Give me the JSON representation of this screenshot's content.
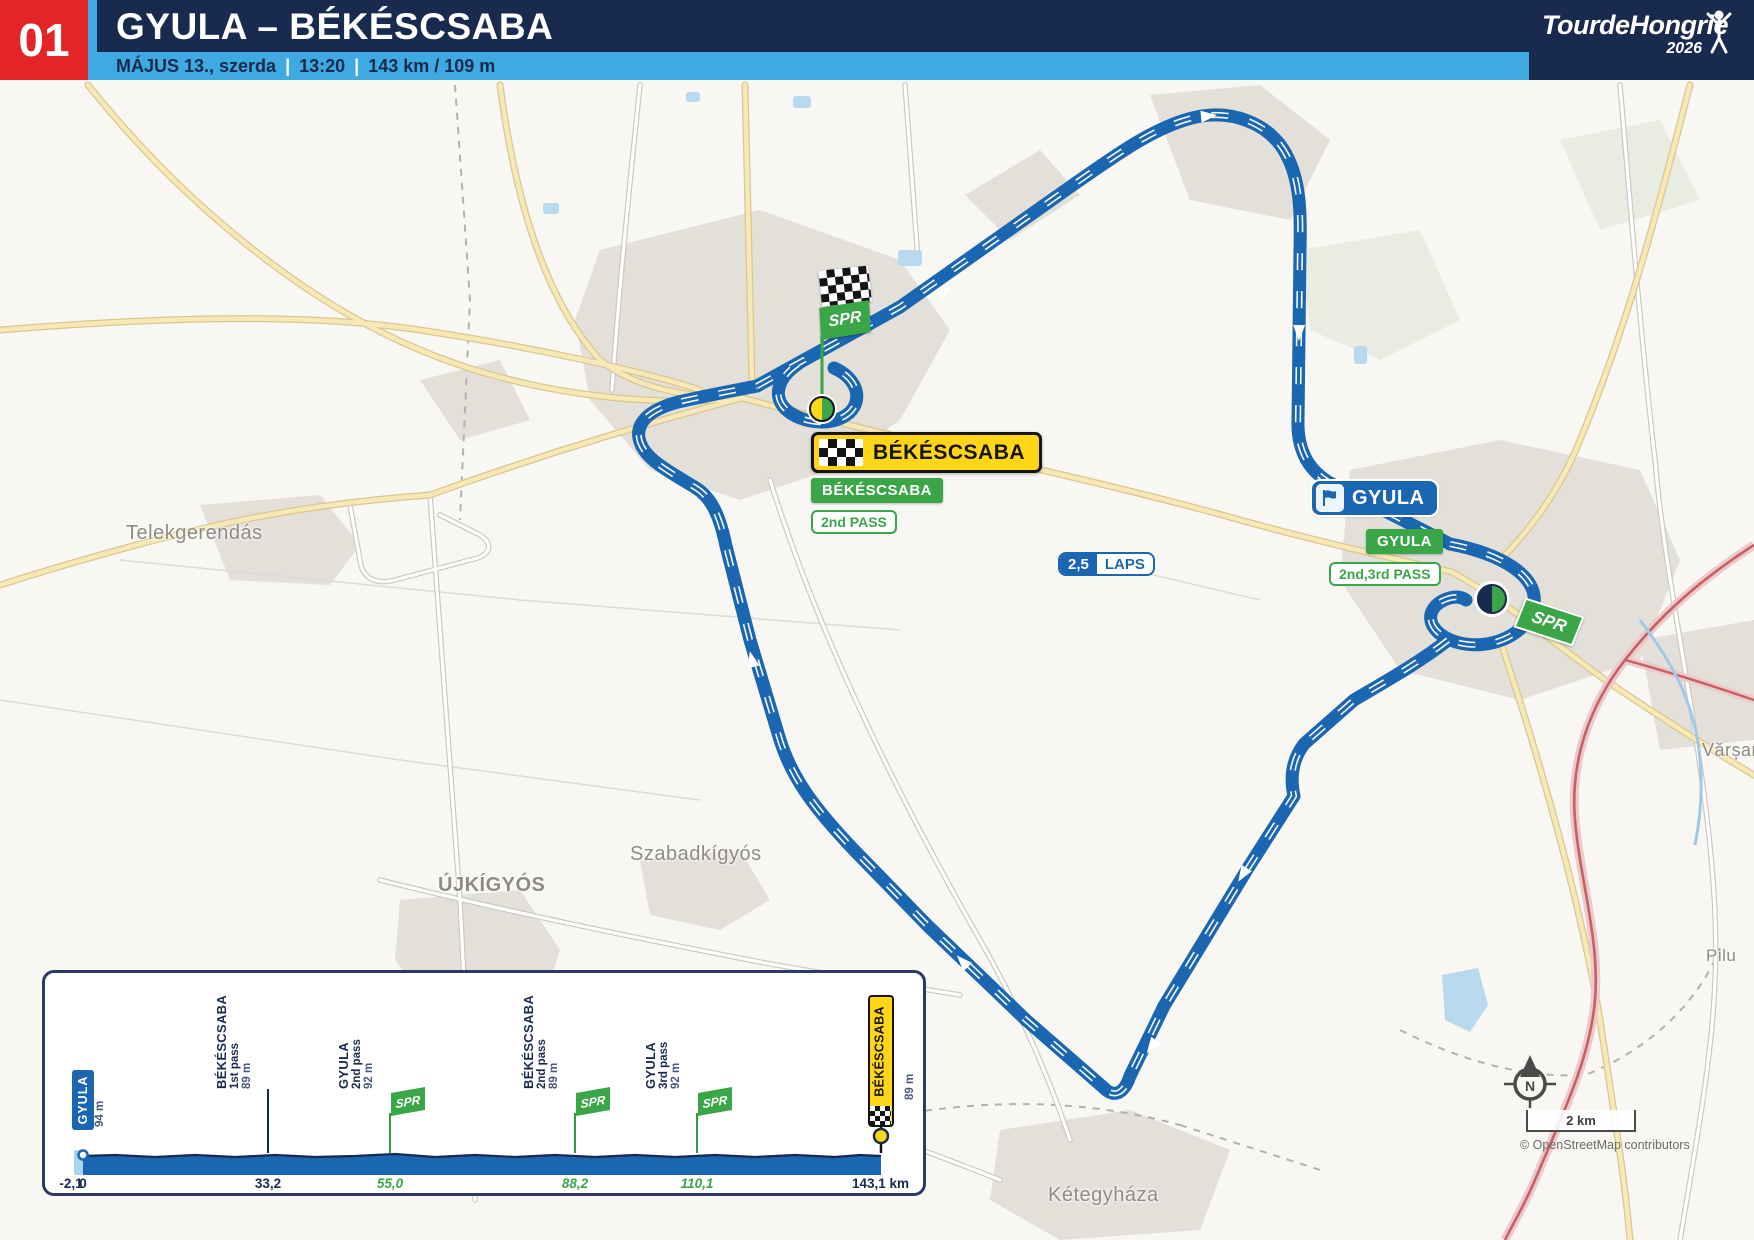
{
  "header": {
    "stage_number": "01",
    "title": "GYULA – BÉKÉSCSABA",
    "date": "MÁJUS 13., szerda",
    "start_time": "13:20",
    "distance_elevation": "143 km / 109 m",
    "separator": "|",
    "logo": {
      "name": "TourdeHongrie",
      "year": "2026"
    }
  },
  "map": {
    "towns": {
      "telekgerendas": "Telekgerendás",
      "szabadkigyos": "Szabadkígyós",
      "ujkigyos": "ÚJKÍGYÓS",
      "ketegyhaza": "Kétegyháza",
      "varsand": "Vărșand",
      "pilu": "Pilu"
    },
    "finish_sign": "BÉKÉSCSABA",
    "finish_pass_sign": "BÉKÉSCSABA",
    "finish_pass_note": "2nd PASS",
    "laps_value": "2,5",
    "laps_word": "LAPS",
    "start_sign": "GYULA",
    "start_pass_sign": "GYULA",
    "start_pass_note": "2nd,3rd PASS",
    "sprint_flag": "SPR",
    "compass": "N",
    "scale_label": "2 km",
    "attribution": "© OpenStreetMap contributors"
  },
  "profile": {
    "start": {
      "name": "GYULA",
      "elevation": "94 m",
      "km": "0",
      "pre_km": "-2,1"
    },
    "finish": {
      "name": "BÉKÉSCSABA",
      "elevation": "89 m",
      "km": "143,1 km"
    },
    "waypoints": [
      {
        "name": "BÉKÉSCSABA",
        "pass": "1st pass",
        "elevation": "89 m",
        "km": "33,2"
      },
      {
        "name": "GYULA",
        "pass": "2nd pass",
        "elevation": "92 m",
        "km": "55,0"
      },
      {
        "name": "BÉKÉSCSABA",
        "pass": "2nd pass",
        "elevation": "89 m",
        "km": "88,2"
      },
      {
        "name": "GYULA",
        "pass": "3rd pass",
        "elevation": "92 m",
        "km": "110,1"
      }
    ]
  },
  "chart_data": {
    "type": "area",
    "title": "Stage 01 elevation profile",
    "x_km": [
      -2.1,
      0,
      33.2,
      55.0,
      88.2,
      110.1,
      143.1
    ],
    "elevation_m": [
      94,
      94,
      89,
      92,
      89,
      92,
      89
    ],
    "xlabel": "km",
    "ylabel": "m",
    "markers": [
      "GYULA start 94 m @ 0 km",
      "BÉKÉSCSABA 1st pass 89 m @ 33,2 km",
      "GYULA 2nd pass SPR 92 m @ 55,0 km",
      "BÉKÉSCSABA 2nd pass SPR 89 m @ 88,2 km",
      "GYULA 3rd pass SPR 92 m @ 110,1 km",
      "BÉKÉSCSABA finish 89 m @ 143,1 km"
    ]
  },
  "colors": {
    "navy": "#182a4d",
    "red": "#e42528",
    "light_blue": "#3fa9e2",
    "route_blue": "#1b66b0",
    "green": "#3aa648",
    "yellow": "#ffd616"
  }
}
